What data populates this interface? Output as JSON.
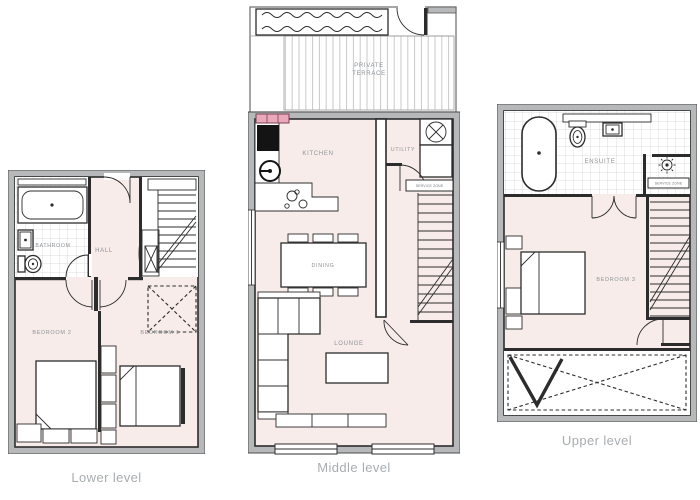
{
  "colors": {
    "background": "#ffffff",
    "floor_fill": "#f7ece9",
    "exterior_wall": "#b7b8ba",
    "interior_line": "#2c2c2c",
    "level_label_text": "#a8adb0",
    "room_label_text": "#8e9397",
    "radiator_pink": "#e9a9ba",
    "tile_line": "#d4d4d4",
    "deck_line": "#b3b3b3"
  },
  "levels": {
    "lower": {
      "label": "Lower level",
      "rooms": {
        "bathroom": "BATHROOM",
        "hall": "HALL",
        "bedroom2": "BEDROOM 2",
        "bedroom1": "BEDROOM 1"
      }
    },
    "middle": {
      "label": "Middle level",
      "rooms": {
        "terrace_line1": "PRIVATE",
        "terrace_line2": "TERRACE",
        "kitchen": "KITCHEN",
        "utility": "UTILITY",
        "dining": "DINING",
        "lounge": "LOUNGE",
        "service_zone": "SERVICE ZONE"
      }
    },
    "upper": {
      "label": "Upper level",
      "rooms": {
        "ensuite": "ENSUITE",
        "bedroom3": "BEDROOM 3",
        "service_zone": "SERVICE ZONE"
      }
    }
  }
}
